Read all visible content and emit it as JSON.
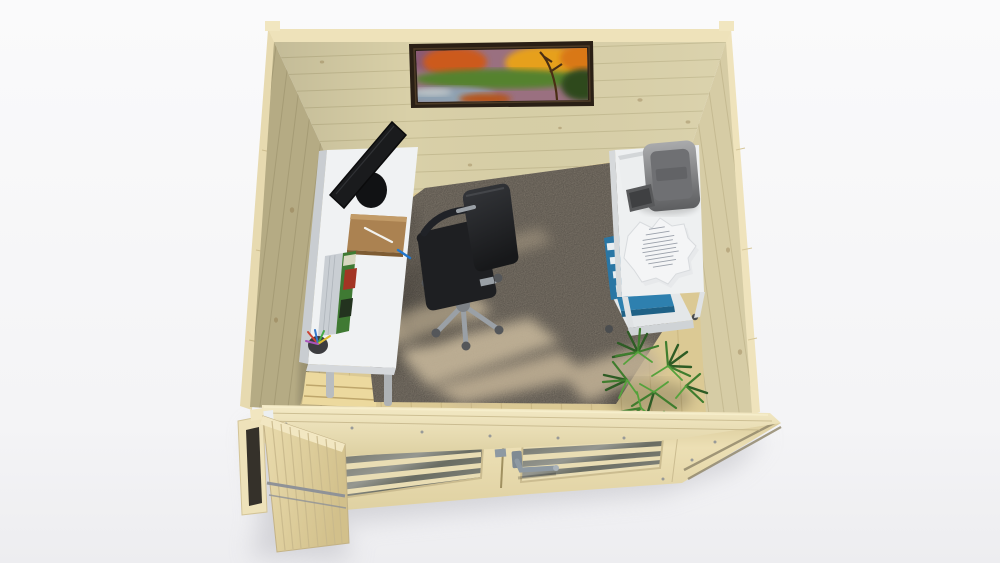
{
  "title": "Overhead 3D cutaway render of a wooden garden log-cabin home office with desk, monitor, office chair, printer stand and plant",
  "colors": {
    "background": "#f6f6f8",
    "ground_shadow": "#bcbcc2",
    "wood_edge": "#eee2ba",
    "wall_back": "#d9d0a8",
    "wall_left": "#b5ab84",
    "wall_right": "#d6cca5",
    "floor_wood": "#dbc994",
    "floor_sunlit": "#ecd99e",
    "carpet": "#8f8679",
    "carpet_light": "#c9b99c",
    "painting_frame": "#2a1f15",
    "desk_top": "#f0f2f3",
    "desk_edge": "#c9cdd1",
    "monitor_black": "#1a1b1d",
    "notebook_brown": "#ab8251",
    "chair_black": "#1e1f22",
    "chair_silver": "#9aa0a6",
    "stand_white": "#eef0f1",
    "printer_gray": "#6f7073",
    "file_blue": "#2e80af",
    "paper_white": "#f4f5f6",
    "plant_green_dark": "#2e5c25",
    "plant_green": "#3f7d2e",
    "plant_green_light": "#55a23c",
    "door_glass": "#5d6055",
    "handle_silver": "#8e99a2",
    "door_slot_dark": "#35312a"
  },
  "objects": {
    "building": "log cabin shell seen from above, front double doors, one side door open",
    "painting": "autumn landscape picture on back wall",
    "desk": "white desk with monitor, brown notebook, book, pen cup",
    "chair": "black swivel office chair on star base",
    "printer_stand": "white rolling stand with printer, documents and blue file boxes",
    "plant": "green palm plant in front-right corner",
    "carpet": "grey carpet with sunlight patches",
    "doors": "slatted double doors with glazing bars and metal lever handle"
  }
}
